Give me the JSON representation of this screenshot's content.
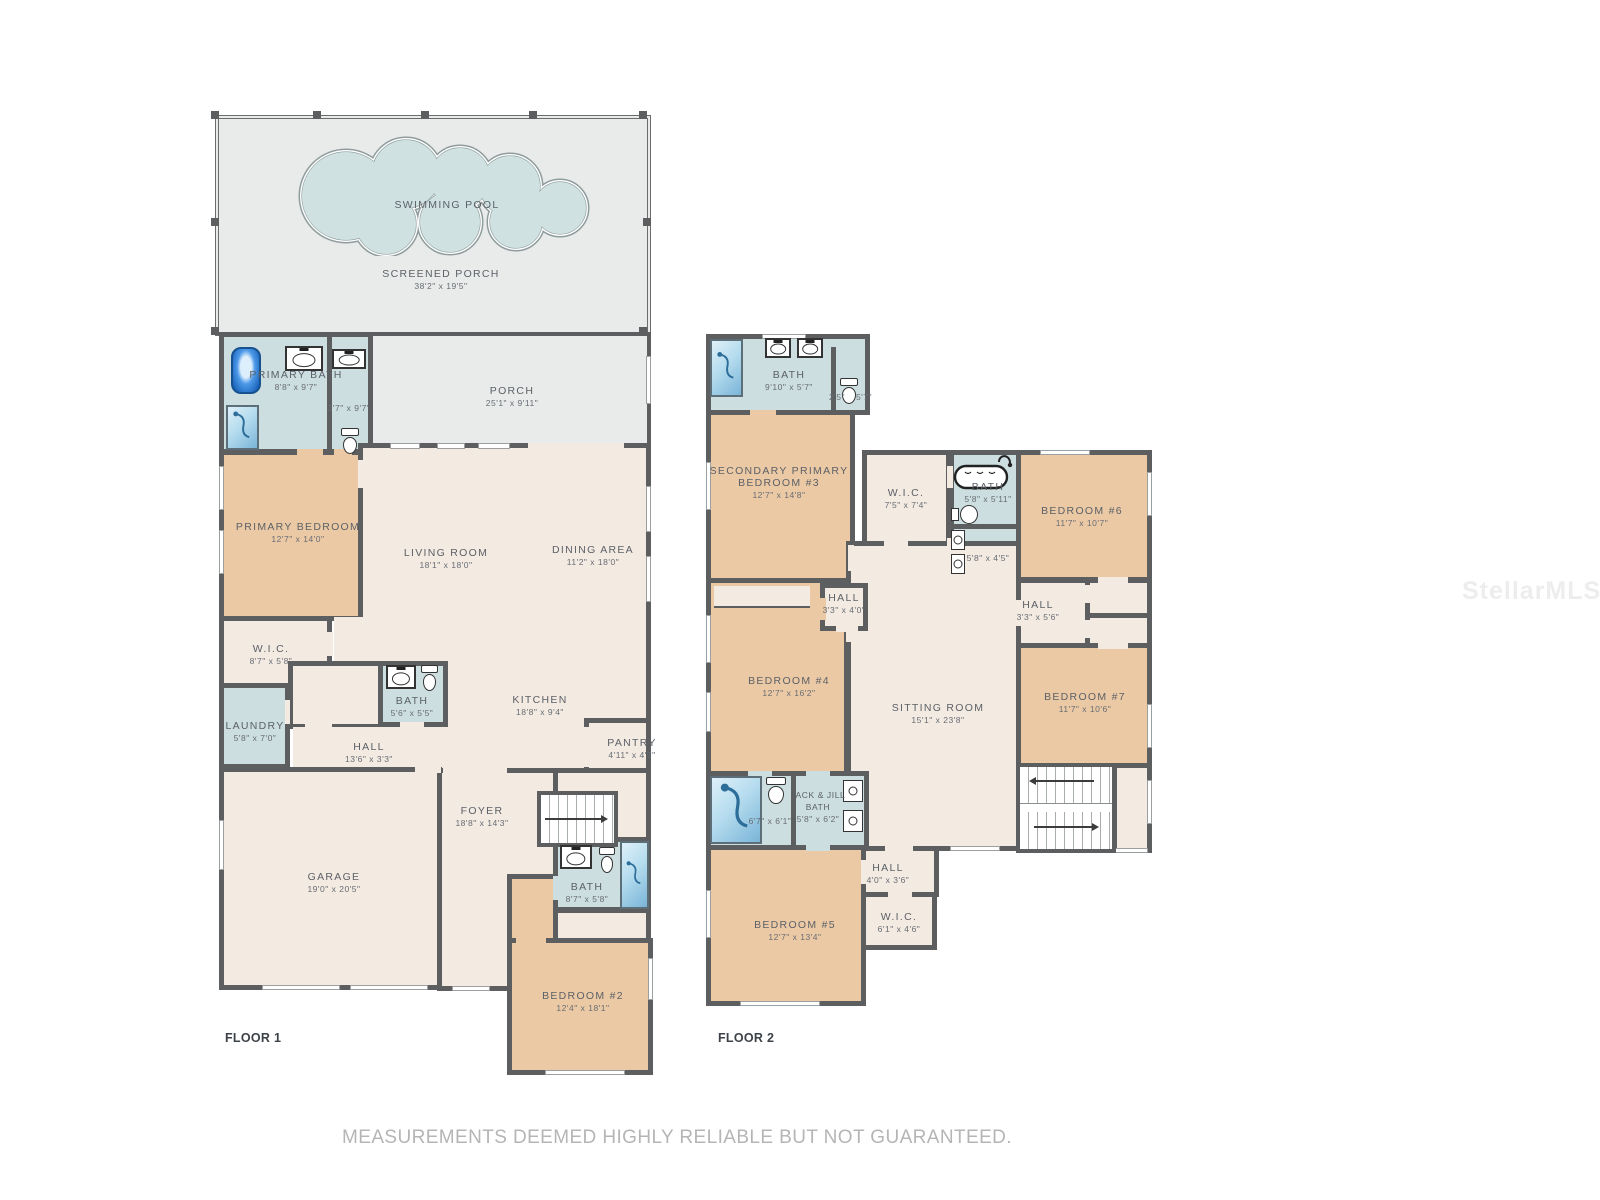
{
  "page": {
    "footer_disclaimer": "MEASUREMENTS DEEMED HIGHLY RELIABLE BUT NOT GUARANTEED.",
    "watermark": "StellarMLS"
  },
  "colors": {
    "bedroom": "#ebc9a5",
    "bath": "#ccdee0",
    "living": "#f3eae2",
    "porch": "#e9ebeb",
    "wall": "#5c5e60",
    "pool": "#cfe1e1"
  },
  "floor1": {
    "label": "FLOOR 1",
    "swimming_pool": {
      "name": "SWIMMING POOL"
    },
    "screened_porch": {
      "name": "SCREENED PORCH",
      "dims": "38'2\" x 19'5\""
    },
    "porch": {
      "name": "PORCH",
      "dims": "25'1\" x 9'11\""
    },
    "primary_bath": {
      "name": "PRIMARY BATH",
      "dims": "8'8\" x 9'7\""
    },
    "water_closet": {
      "dims": "3'7\" x 9'7\""
    },
    "primary_bedroom": {
      "name": "PRIMARY BEDROOM",
      "dims": "12'7\" x 14'0\""
    },
    "living_room": {
      "name": "LIVING ROOM",
      "dims": "18'1\" x 18'0\""
    },
    "dining_area": {
      "name": "DINING AREA",
      "dims": "11'2\" x 18'0\""
    },
    "wic": {
      "name": "W.I.C.",
      "dims": "8'7\" x 5'8\""
    },
    "laundry": {
      "name": "LAUNDRY",
      "dims": "5'8\" x 7'0\""
    },
    "bath": {
      "name": "BATH",
      "dims": "5'6\" x 5'5\""
    },
    "hall": {
      "name": "HALL",
      "dims": "13'6\" x 3'3\""
    },
    "kitchen": {
      "name": "KITCHEN",
      "dims": "18'8\" x 9'4\""
    },
    "pantry": {
      "name": "PANTRY",
      "dims": "4'11\" x 4'7\""
    },
    "foyer": {
      "name": "FOYER",
      "dims": "18'8\" x 14'3\""
    },
    "garage": {
      "name": "GARAGE",
      "dims": "19'0\" x 20'5\""
    },
    "bath2": {
      "name": "BATH",
      "dims": "8'7\" x 5'8\""
    },
    "bedroom2": {
      "name": "BEDROOM #2",
      "dims": "12'4\" x 18'1\""
    }
  },
  "floor2": {
    "label": "FLOOR 2",
    "bath3": {
      "name": "BATH",
      "dims": "9'10\" x 5'7\""
    },
    "water_closet2": {
      "dims_left": "2'5\"",
      "dims_right": "5'7\""
    },
    "bedroom3": {
      "name_line1": "SECONDARY PRIMARY",
      "name_line2": "BEDROOM #3",
      "dims": "12'7\" x 14'8\""
    },
    "wic2": {
      "name": "W.I.C.",
      "dims": "7'5\" x 7'4\""
    },
    "bath4": {
      "name": "BATH",
      "dims": "5'8\" x 5'11\""
    },
    "linen": {
      "dims": "5'8\" x 4'5\""
    },
    "bedroom6": {
      "name": "BEDROOM #6",
      "dims": "11'7\" x 10'7\""
    },
    "hall_a": {
      "name": "HALL",
      "dims": "3'3\" x 4'0\""
    },
    "hall_b": {
      "name": "HALL",
      "dims": "3'3\" x 5'6\""
    },
    "bedroom4": {
      "name": "BEDROOM #4",
      "dims": "12'7\" x 16'2\""
    },
    "sitting_room": {
      "name": "SITTING ROOM",
      "dims": "15'1\" x 23'8\""
    },
    "bedroom7": {
      "name": "BEDROOM #7",
      "dims": "11'7\" x 10'6\""
    },
    "shower_room": {
      "dims": "6'7\" x 6'1\""
    },
    "jack_jill_bath": {
      "name_line1": "JACK & JILL",
      "name_line2": "BATH",
      "dims": "5'8\" x 6'2\""
    },
    "hall_c": {
      "name": "HALL",
      "dims": "4'0\" x 3'6\""
    },
    "wic3": {
      "name": "W.I.C.",
      "dims": "6'1\" x 4'6\""
    },
    "bedroom5": {
      "name": "BEDROOM #5",
      "dims": "12'7\" x 13'4\""
    }
  }
}
